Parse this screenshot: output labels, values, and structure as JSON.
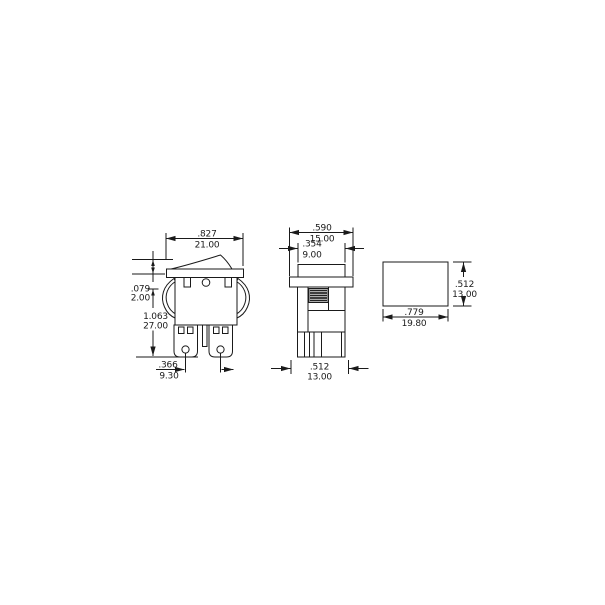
{
  "colors": {
    "line": "#1a1a1a",
    "background": "#ffffff"
  },
  "views": {
    "side": {
      "overall_width": {
        "in": ".827",
        "mm": "21.00"
      },
      "bezel_height": {
        "in": ".079",
        "mm": "2.00"
      },
      "overall_height": {
        "in": "1.063",
        "mm": "27.00"
      },
      "terminal_spacing": {
        "in": ".366",
        "mm": "9.30"
      }
    },
    "front": {
      "bezel_width": {
        "in": ".590",
        "mm": "15.00"
      },
      "actuator_width": {
        "in": ".354",
        "mm": "9.00"
      },
      "body_width": {
        "in": ".512",
        "mm": "13.00"
      }
    },
    "panel_cutout": {
      "width": {
        "in": ".779",
        "mm": "19.80"
      },
      "height": {
        "in": ".512",
        "mm": "13.00"
      }
    }
  }
}
